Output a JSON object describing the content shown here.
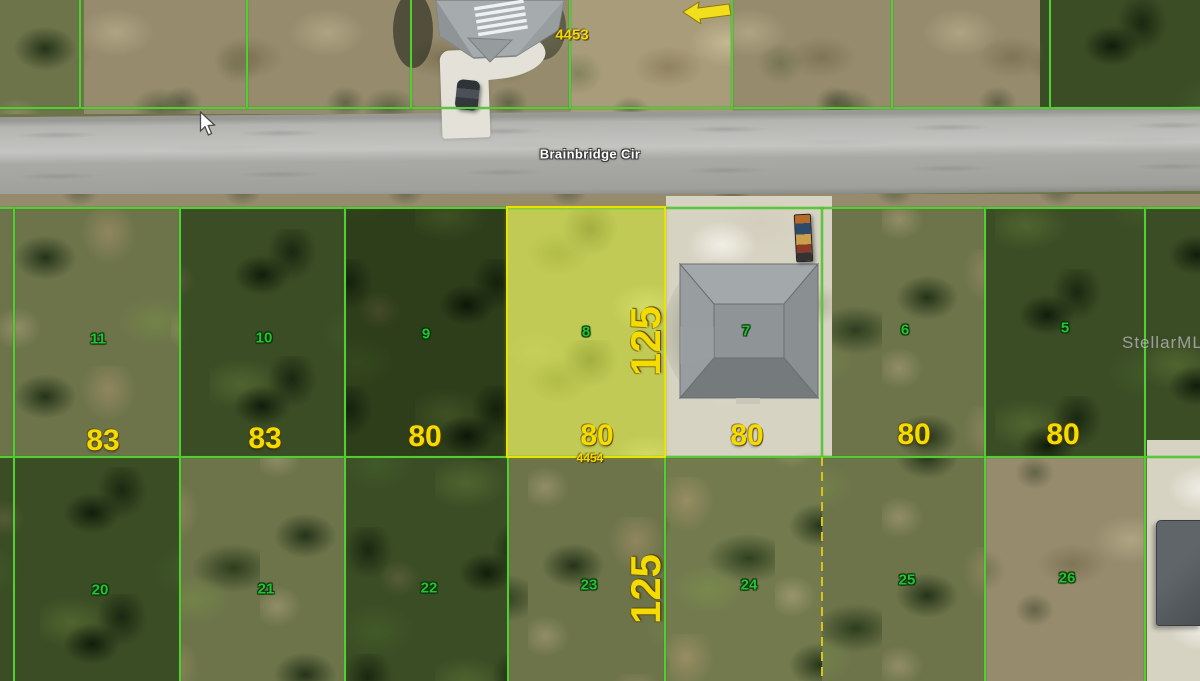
{
  "street": {
    "name": "Brainbridge Cir"
  },
  "parcels": {
    "top_row_id": "4453",
    "selected_id": "4454",
    "front_row": [
      {
        "number": "11",
        "width": "83"
      },
      {
        "number": "10",
        "width": "83"
      },
      {
        "number": "9",
        "width": "80"
      },
      {
        "number": "8",
        "width": "80",
        "depth": "125",
        "selected": true
      },
      {
        "number": "7",
        "width": "80"
      },
      {
        "number": "6",
        "width": "80"
      },
      {
        "number": "5",
        "width": "80"
      }
    ],
    "back_row": [
      {
        "number": "20"
      },
      {
        "number": "21"
      },
      {
        "number": "22"
      },
      {
        "number": "23",
        "depth": "125"
      },
      {
        "number": "24"
      },
      {
        "number": "25"
      },
      {
        "number": "26"
      }
    ]
  },
  "watermark": "StellarMLS",
  "icons": {
    "cursor": "mouse-pointer-arrow",
    "annotation_arrow": "left-arrow"
  },
  "colors": {
    "boundary_green": "#54cc33",
    "highlight_yellow": "#e9e303",
    "dimension_yellow": "#f4dc00",
    "lot_number_green": "#25c232",
    "dashed_boundary_yellow": "#d6c41c",
    "street_label": "#ffffff",
    "road_gray": "#b4b5b1"
  }
}
